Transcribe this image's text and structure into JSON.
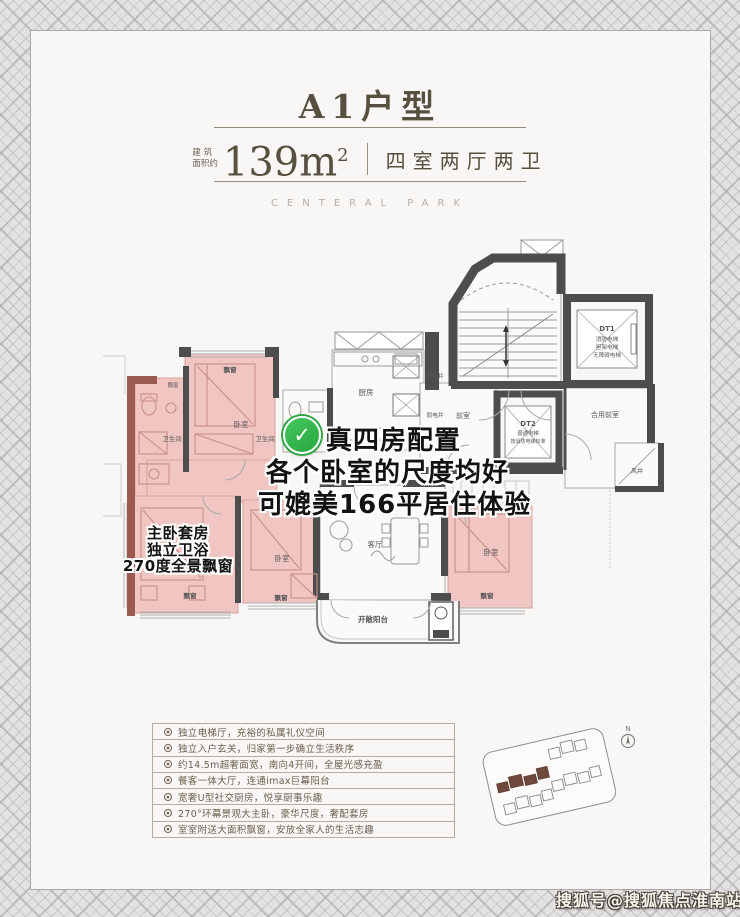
{
  "card": {
    "title": "A1户型",
    "area_label_top": "建 筑",
    "area_label_bottom": "面积约",
    "area_value": "139m",
    "area_sup": "2",
    "layout_text": "四室两厅两卫",
    "brand_caption": "CENTERAL PARK"
  },
  "floorplan": {
    "labels": {
      "bay_window": "飘窗",
      "bedroom": "卧室",
      "bathroom": "卫生间",
      "kitchen": "厨房",
      "living_room": "客厅",
      "open_balcony": "开敞阳台",
      "front_room": "前室",
      "shared_front_room": "合用前室",
      "wind_shaft": "风井",
      "strong_electric_shaft": "强电井",
      "weak_electric_shaft": "弱电井"
    },
    "elevator_dt1": {
      "code": "DT1",
      "line1": "消防电梯",
      "line2": "担架电梯",
      "line3": "无障碍电梯"
    },
    "elevator_dt2": {
      "code": "DT2",
      "line1": "普通电梯",
      "line2": "按消防电梯标准"
    },
    "highlight_note": {
      "line1": "真四房配置",
      "line2": "各个卧室的尺度均好",
      "line3": "可媲美166平居住体验"
    },
    "master_note": {
      "line1": "主卧套房",
      "line2": "独立卫浴",
      "line3": "270度全景飘窗"
    },
    "compass_label": "N"
  },
  "features": {
    "items": [
      "独立电梯厅，充裕的私属礼仪空间",
      "独立入户玄关，归家第一步确立生活秩序",
      "约14.5m超奢面宽，南向4开间，全屋光感充盈",
      "餐客一体大厅，连通imax巨幕阳台",
      "宽奢U型社交厨房，悦享厨事乐趣",
      "270°环幕景观大主卧，豪华尺度，奢配套房",
      "室室附送大面积飘窗，安放全家人的生活志趣"
    ]
  },
  "icons": {
    "check": "✓"
  },
  "watermark": {
    "text": "搜狐号@搜狐焦点淮南站"
  },
  "colors": {
    "room_pink": "#f1c6c2",
    "wall_dark": "#4d4d4d",
    "wall_maroon": "#9b5b50",
    "check_green": "#35b94f",
    "header_text": "#57503f",
    "site_building_fill": "#6f4a3c"
  }
}
